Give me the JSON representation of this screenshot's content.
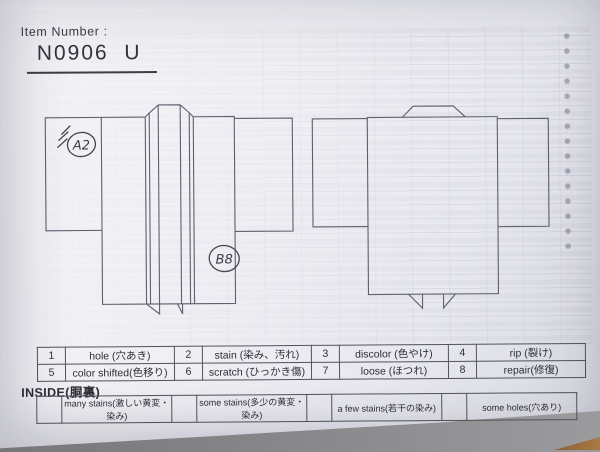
{
  "header": {
    "item_number_label": "Item Number :",
    "item_number_value": "N0906  U"
  },
  "annotations": {
    "a": {
      "label": "A2"
    },
    "b": {
      "label": "B8"
    }
  },
  "defect_table": {
    "rows": [
      [
        {
          "num": "1",
          "label": "hole (穴あき)"
        },
        {
          "num": "2",
          "label": "stain (染み、汚れ)"
        },
        {
          "num": "3",
          "label": "discolor (色やけ)"
        },
        {
          "num": "4",
          "label": "rip (裂け)"
        }
      ],
      [
        {
          "num": "5",
          "label": "color shifted(色移り)"
        },
        {
          "num": "6",
          "label": "scratch (ひっかき傷)"
        },
        {
          "num": "7",
          "label": "loose (ほつれ)"
        },
        {
          "num": "8",
          "label": "repair(修復)"
        }
      ]
    ]
  },
  "inside_section": {
    "title": "INSIDE(胴裏)",
    "options": [
      "many stains(激しい黄変・染み)",
      "some stains(多少の黄変・染み)",
      "a few stains(若干の染み)",
      "some holes(穴あり)"
    ]
  }
}
